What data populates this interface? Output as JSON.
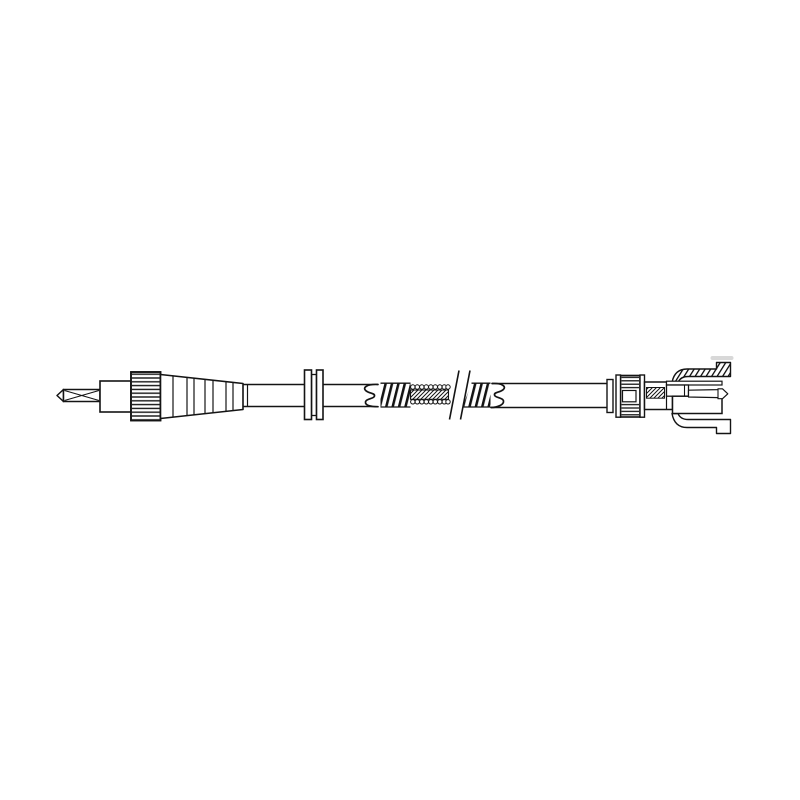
{
  "page": {
    "background_color": "#ffffff"
  },
  "drawing": {
    "type": "technical-line-drawing",
    "subject": "Speedometer drive cable assembly",
    "ink_color": "#141414",
    "paper_color": "#ffffff",
    "artifact_color": "#d8d8d8",
    "alt_text": "Monochrome technical line drawing of a speedometer drive cable assembly: a square-drive inner tip, collar, knurled coupling nut and stepped ferrule on the left end; a smooth outer casing passing through a double-flanged bulkhead grommet; a cut-away section showing helical wire armour and the hatched inner core interrupted by a drafting break symbol; and on the right end a ribbed retainer nut, hatched drive shaft and a snap-in connector housing with upper and lower spring clips and a pointed drive pin.",
    "parts": [
      {
        "id": "square-drive-tip",
        "label": "Square drive tip"
      },
      {
        "id": "tip-collar",
        "label": "Tip collar"
      },
      {
        "id": "knurled-coupling-nut",
        "label": "Knurled coupling nut"
      },
      {
        "id": "stepped-ferrule",
        "label": "Stepped ferrule"
      },
      {
        "id": "outer-casing-left",
        "label": "Outer casing, left run"
      },
      {
        "id": "bulkhead-grommet",
        "label": "Bulkhead grommet"
      },
      {
        "id": "casing-boot-left",
        "label": "Casing boot, left"
      },
      {
        "id": "helical-armour-left",
        "label": "Helical wire armour, left of break"
      },
      {
        "id": "inner-core",
        "label": "Inner core with strand beads"
      },
      {
        "id": "break-symbol",
        "label": "Drafting break symbol"
      },
      {
        "id": "helical-armour-right",
        "label": "Helical wire armour, right of break"
      },
      {
        "id": "casing-boot-right",
        "label": "Casing boot, right"
      },
      {
        "id": "outer-casing-right",
        "label": "Outer casing, right run"
      },
      {
        "id": "ribbed-retainer-nut",
        "label": "Ribbed retainer nut with flanges"
      },
      {
        "id": "drive-shaft",
        "label": "Drive shaft with hatched band"
      },
      {
        "id": "connector-housing",
        "label": "Snap-in connector housing"
      },
      {
        "id": "spring-clip-upper",
        "label": "Upper spring clip, hatched"
      },
      {
        "id": "spring-clip-lower",
        "label": "Lower spring clip"
      },
      {
        "id": "drive-pin",
        "label": "Pointed drive pin"
      },
      {
        "id": "print-artifact",
        "label": "Faint print artifact"
      }
    ]
  }
}
